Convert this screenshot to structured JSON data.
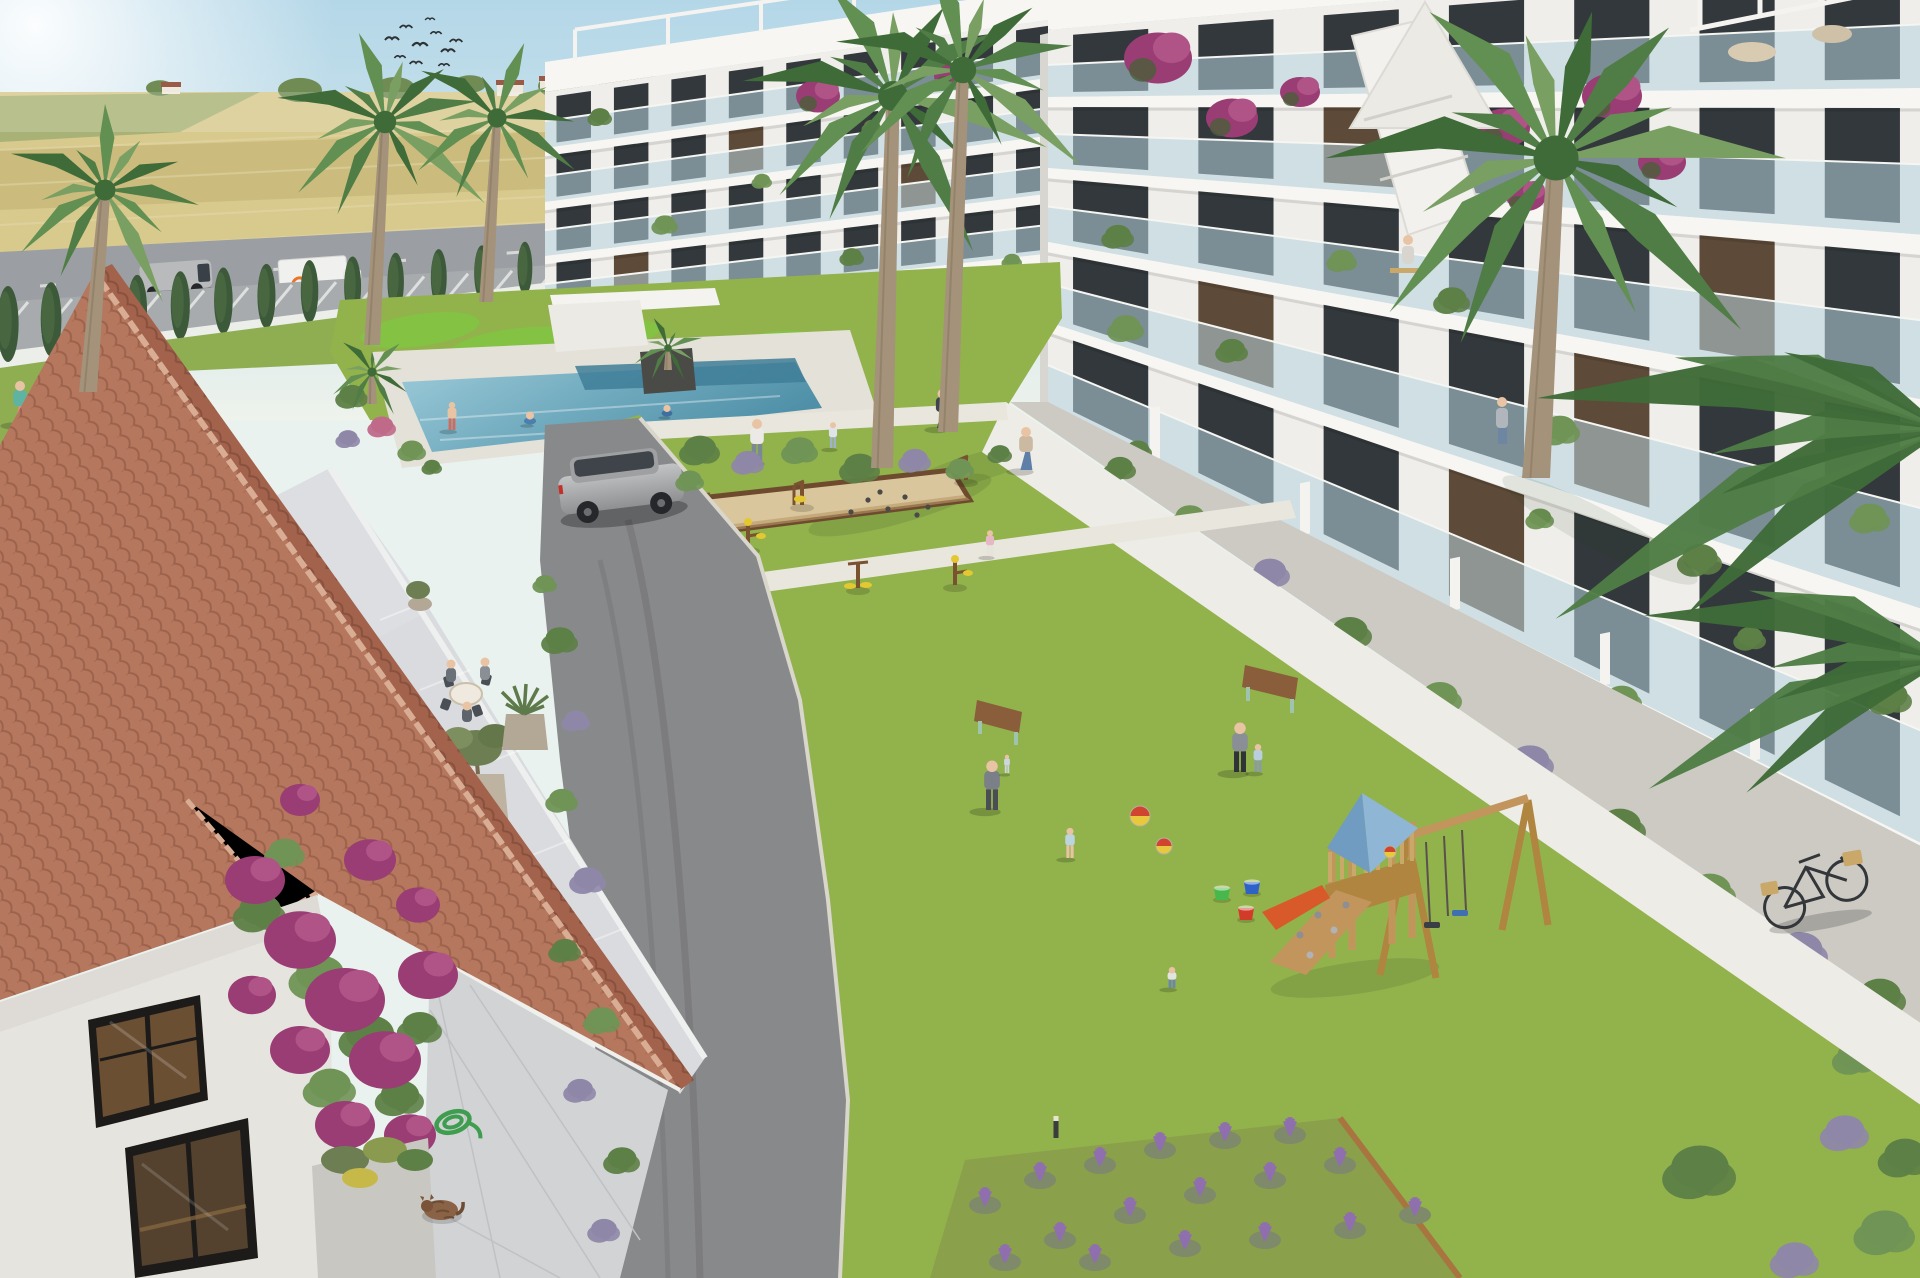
{
  "meta": {
    "title": "Aerial architectural rendering of a new-build residential complex",
    "alt": "Sunny aerial render: white modern apartment blocks with glass balconies around a green courtyard with pool, petanque court, outdoor gym, wooden playground, palm trees, and a terracotta-roofed Spanish house in the foreground; golden fields, a road with vehicles and a cypress-lined fence in the background."
  },
  "palette": {
    "sky1": "#badbe9",
    "sky2": "#eaf2ef",
    "sun": "#ffffff",
    "fieldGold": "#d8c98d",
    "fieldGold2": "#cbbc7e",
    "fieldGreen": "#a9b276",
    "distTree": "#708b54",
    "road": "#9b9fa3",
    "parking": "#a7abae",
    "fence": "#eceee9",
    "cypress": "#3c5a39",
    "grass": "#92b24c",
    "grassStrip": "#8fae52",
    "mound": "#84c244",
    "path": "#e9e7dd",
    "walkway": "#edece6",
    "asphalt": "#88898b",
    "curb": "#d9d6cc",
    "deck": "#e3e1d8",
    "pool1": "#93c6d6",
    "pool2": "#4f90a8",
    "poolDeep": "#3f7e98",
    "white": "#f4f3f0",
    "slab": "#f7f6f3",
    "face": "#efeeea",
    "faceShade": "#e1dfd9",
    "glass": "#b7d3de",
    "win": "#33383c",
    "winWarm": "#5d4a38",
    "roofA": "#b5775d",
    "roofB": "#a2624c",
    "ridge": "#d9ad93",
    "stucco": "#e6e4df",
    "terrace": "#d9dbde",
    "pavers": "#d2d3d5",
    "planter": "#cccac3",
    "g1": "#5d8046",
    "g2": "#6f9455",
    "lav": "#8f87a8",
    "lavPurple": "#8f6fae",
    "pink": "#c06a8a",
    "boug": "#993d74",
    "boug2": "#b05488",
    "wood": "#c2955c",
    "woodDark": "#9c7240",
    "playRoofL": "#6f9cc0",
    "playRoofR": "#8fb6d4",
    "slide": "#d85a2b",
    "sand": "#d9c69c",
    "sandEdge": "#6e4a2e",
    "yellow": "#e3c832",
    "skin": "#e9c4a4",
    "suv": "#a8a9ab",
    "van": "#b9babc",
    "truck": "#f0f0ee",
    "redCar": "#c4342b",
    "bench": "#8a5d3b",
    "benchLeg": "#9fc4ad",
    "bike": "#33363a",
    "basket": "#c9a86a",
    "cat": "#8a6246",
    "hose": "#3f9d4f",
    "trunk": "#a4927a",
    "palm1": "#4f7d45",
    "palm2": "#628f52",
    "palm3": "#79a062",
    "palmDark": "#3f6b38",
    "bird": "#2c3134"
  },
  "buildings": {
    "center": {
      "x1": 545,
      "x2": 1062,
      "bays": 9,
      "slabL": 8,
      "slabR": 10,
      "boundaries": [
        [
          92,
          18
        ],
        [
          148,
          76
        ],
        [
          202,
          134
        ],
        [
          256,
          192
        ],
        [
          310,
          252
        ],
        [
          352,
          300
        ]
      ],
      "warm": [
        [],
        [
          3
        ],
        [
          6
        ],
        [
          1
        ],
        []
      ],
      "parapet": {
        "top": [
          62,
          -14
        ]
      },
      "pergola": {
        "x1": 575,
        "x2": 1040,
        "n": 6,
        "h": 28
      }
    },
    "right": {
      "x1": 1048,
      "x2": 1925,
      "bays": 7,
      "slabL": 10,
      "slabR": 20,
      "boundaries": [
        [
          30,
          -45
        ],
        [
          97,
          88
        ],
        [
          168,
          235
        ],
        [
          242,
          400
        ],
        [
          322,
          610
        ],
        [
          405,
          845
        ]
      ],
      "warm": [
        [],
        [
          2
        ],
        [
          5
        ],
        [
          1,
          4
        ],
        [
          3
        ]
      ],
      "parapet": {
        "top": [
          -6,
          -95
        ]
      },
      "dividers": [
        1150,
        1300,
        1450,
        1600,
        1750
      ]
    }
  },
  "gen": {
    "birds": [
      [
        392,
        40,
        1
      ],
      [
        406,
        28,
        0.9
      ],
      [
        420,
        46,
        1.1
      ],
      [
        436,
        34,
        0.8
      ],
      [
        448,
        52,
        1
      ],
      [
        400,
        58,
        0.8
      ],
      [
        416,
        64,
        0.9
      ],
      [
        430,
        20,
        0.7
      ],
      [
        444,
        66,
        0.8
      ],
      [
        456,
        42,
        0.9
      ]
    ],
    "cypresses": {
      "x1": 8,
      "y1": 362,
      "x2": 1128,
      "y2": 216,
      "n": 27,
      "h1": 76,
      "h2": 26
    },
    "parking_lines": {
      "x1": 28,
      "y1": 302,
      "x2": 556,
      "y2": 268,
      "n": 13,
      "dx": -30,
      "dy": 36
    },
    "road_dashes": {
      "x1": 40,
      "y1": 286,
      "x2": 1090,
      "y2": 212,
      "n": 10,
      "len": 16
    },
    "dist_trees": [
      [
        300,
        90,
        22
      ],
      [
        395,
        88,
        20
      ],
      [
        470,
        84,
        16
      ],
      [
        560,
        86,
        22
      ],
      [
        640,
        82,
        18
      ],
      [
        700,
        86,
        16
      ],
      [
        860,
        84,
        20
      ],
      [
        960,
        82,
        16
      ],
      [
        1040,
        84,
        18
      ],
      [
        160,
        88,
        14
      ]
    ],
    "houses": [
      [
        497,
        84,
        26,
        12
      ],
      [
        540,
        80,
        20,
        10
      ],
      [
        600,
        84,
        26,
        10
      ],
      [
        162,
        86,
        18,
        8
      ]
    ],
    "mounds": [
      [
        420,
        330,
        60,
        16,
        -8
      ],
      [
        520,
        346,
        70,
        18,
        -6
      ],
      [
        610,
        333,
        50,
        14,
        -5
      ],
      [
        470,
        363,
        80,
        16,
        -7
      ],
      [
        700,
        352,
        46,
        12,
        -4
      ],
      [
        780,
        342,
        40,
        11,
        -4
      ]
    ],
    "balcony_plants": [
      [
        600,
        118,
        12,
        "g1"
      ],
      [
        665,
        226,
        13,
        "g2"
      ],
      [
        703,
        298,
        12,
        "g1"
      ],
      [
        762,
        182,
        10,
        "g2"
      ],
      [
        852,
        258,
        12,
        "g1"
      ],
      [
        948,
        298,
        11,
        "g2"
      ],
      [
        872,
        128,
        10,
        "g1"
      ],
      [
        1012,
        262,
        10,
        "g2"
      ],
      [
        1118,
        238,
        16,
        "g1"
      ],
      [
        1126,
        330,
        18,
        "g2"
      ],
      [
        1232,
        352,
        16,
        "g1"
      ],
      [
        1342,
        262,
        15,
        "g2"
      ],
      [
        1452,
        302,
        18,
        "g1"
      ],
      [
        1560,
        432,
        20,
        "g2"
      ],
      [
        1700,
        562,
        22,
        "g1"
      ],
      [
        1262,
        522,
        16,
        "g2"
      ],
      [
        1422,
        622,
        18,
        "g1"
      ],
      [
        1622,
        702,
        20,
        "g2"
      ],
      [
        1138,
        452,
        14,
        "g1"
      ],
      [
        1870,
        520,
        20,
        "g2"
      ],
      [
        1890,
        700,
        22,
        "g1"
      ],
      [
        1540,
        520,
        14,
        "g2"
      ],
      [
        1750,
        640,
        16,
        "g1"
      ]
    ],
    "bougainvillea": [
      [
        1158,
        58,
        34
      ],
      [
        1232,
        118,
        26
      ],
      [
        1300,
        92,
        20
      ],
      [
        1612,
        96,
        30
      ],
      [
        1662,
        162,
        24
      ],
      [
        1504,
        128,
        26
      ],
      [
        1526,
        196,
        20
      ],
      [
        818,
        96,
        22
      ],
      [
        952,
        76,
        18
      ]
    ],
    "wall_bougainvillea": [
      [
        255,
        880,
        30
      ],
      [
        300,
        940,
        36
      ],
      [
        345,
        1000,
        40
      ],
      [
        385,
        1060,
        36
      ],
      [
        300,
        1050,
        30
      ],
      [
        345,
        1125,
        30
      ],
      [
        410,
        1135,
        26
      ],
      [
        252,
        995,
        24
      ],
      [
        418,
        905,
        22
      ],
      [
        370,
        860,
        26
      ],
      [
        428,
        975,
        30
      ],
      [
        300,
        800,
        20
      ]
    ],
    "wall_greens": [
      [
        260,
        915,
        26,
        "g1"
      ],
      [
        320,
        980,
        30,
        "g2"
      ],
      [
        370,
        1040,
        30,
        "g1"
      ],
      [
        330,
        1090,
        26,
        "g2"
      ],
      [
        400,
        1100,
        24,
        "g1"
      ],
      [
        285,
        855,
        20,
        "g2"
      ],
      [
        420,
        1030,
        22,
        "g1"
      ]
    ],
    "shrub_row_pool": [
      [
        700,
        452,
        20,
        "g1"
      ],
      [
        748,
        464,
        16,
        "lav"
      ],
      [
        800,
        452,
        18,
        "g2"
      ],
      [
        860,
        470,
        20,
        "g1"
      ],
      [
        915,
        462,
        16,
        "lav"
      ],
      [
        960,
        470,
        14,
        "g2"
      ],
      [
        690,
        482,
        14,
        "g2"
      ],
      [
        1000,
        455,
        12,
        "g1"
      ]
    ],
    "bushes_left_path": [
      [
        560,
        642,
        18,
        "g1"
      ],
      [
        576,
        722,
        14,
        "lav"
      ],
      [
        562,
        802,
        16,
        "g2"
      ],
      [
        588,
        882,
        18,
        "lav"
      ],
      [
        565,
        952,
        16,
        "g1"
      ],
      [
        602,
        1022,
        18,
        "g2"
      ],
      [
        580,
        1092,
        16,
        "lav"
      ],
      [
        622,
        1162,
        18,
        "g1"
      ],
      [
        604,
        1232,
        16,
        "lav"
      ],
      [
        545,
        585,
        12,
        "g2"
      ]
    ],
    "pool_west_bushes": [
      [
        352,
        398,
        16,
        "g1"
      ],
      [
        382,
        428,
        14,
        "pink"
      ],
      [
        412,
        452,
        14,
        "g2"
      ],
      [
        348,
        440,
        12,
        "lav"
      ],
      [
        432,
        468,
        10,
        "g1"
      ]
    ],
    "planter_band_bushes": [
      [
        1120,
        470,
        16,
        "g1"
      ],
      [
        1190,
        520,
        18,
        "g2"
      ],
      [
        1270,
        575,
        20,
        "lav"
      ],
      [
        1350,
        635,
        22,
        "g1"
      ],
      [
        1440,
        700,
        22,
        "g2"
      ],
      [
        1530,
        765,
        24,
        "lav"
      ],
      [
        1620,
        830,
        26,
        "g1"
      ],
      [
        1710,
        895,
        26,
        "g2"
      ],
      [
        1800,
        955,
        28,
        "lav"
      ],
      [
        1880,
        1000,
        26,
        "g1"
      ],
      [
        1855,
        1060,
        22,
        "g2"
      ]
    ],
    "corner_bushes": [
      [
        1700,
        1175,
        36,
        "g1"
      ],
      [
        1845,
        1135,
        24,
        "lav"
      ],
      [
        1885,
        1235,
        30,
        "g2"
      ],
      [
        1795,
        1262,
        24,
        "lav"
      ],
      [
        1905,
        1160,
        26,
        "g1"
      ]
    ],
    "lavender_clusters": [
      [
        985,
        1205
      ],
      [
        1040,
        1180
      ],
      [
        1100,
        1165
      ],
      [
        1160,
        1150
      ],
      [
        1225,
        1140
      ],
      [
        1290,
        1135
      ],
      [
        1060,
        1240
      ],
      [
        1130,
        1215
      ],
      [
        1200,
        1195
      ],
      [
        1270,
        1180
      ],
      [
        1340,
        1165
      ],
      [
        1005,
        1262
      ],
      [
        1095,
        1262
      ],
      [
        1185,
        1248
      ],
      [
        1265,
        1240
      ],
      [
        1350,
        1230
      ],
      [
        1415,
        1215
      ],
      [
        640,
        1220
      ],
      [
        660,
        1260
      ]
    ],
    "boules": [
      [
        868,
        500
      ],
      [
        888,
        509
      ],
      [
        905,
        497
      ],
      [
        928,
        507
      ],
      [
        851,
        512
      ],
      [
        917,
        515
      ],
      [
        880,
        492
      ]
    ],
    "bollards": [
      [
        756,
        592
      ],
      [
        792,
        762
      ],
      [
        818,
        938
      ],
      [
        834,
        1122
      ],
      [
        722,
        578
      ],
      [
        1056,
        1138
      ]
    ],
    "gym": [
      [
        700,
        520
      ],
      [
        748,
        548
      ],
      [
        802,
        505
      ],
      [
        858,
        588
      ],
      [
        955,
        585
      ],
      [
        966,
        480
      ]
    ],
    "buckets": [
      [
        1222,
        896,
        "#49b84c"
      ],
      [
        1252,
        890,
        "#2f62c8"
      ],
      [
        1246,
        916,
        "#d23a2a"
      ]
    ],
    "balls": [
      [
        1140,
        816,
        10
      ],
      [
        1164,
        846,
        8
      ],
      [
        1390,
        852,
        6
      ]
    ],
    "people": [
      {
        "x": 20,
        "y": 424,
        "h": 40,
        "shirt": "#5fb3a1",
        "pants": "#e58a9a",
        "pose": "walk",
        "label": "woman-walking-roadside"
      },
      {
        "x": 452,
        "y": 430,
        "h": 26,
        "shirt": "#e9c4a4",
        "pants": "#d16a5a",
        "pose": "stand",
        "label": "swimmer-poolside"
      },
      {
        "x": 530,
        "y": 424,
        "h": 20,
        "shirt": "#e9c4a4",
        "pants": "#4a7fae",
        "pose": "swim",
        "label": "swimmer-in-pool"
      },
      {
        "x": 667,
        "y": 416,
        "h": 18,
        "shirt": "#e9c4a4",
        "pants": "#3f6f9f",
        "pose": "swim",
        "label": "swimmer-in-pool"
      },
      {
        "x": 942,
        "y": 428,
        "h": 36,
        "shirt": "#3d4450",
        "pants": "#3d4450",
        "pose": "walk",
        "label": "resident-on-walkway"
      },
      {
        "x": 1026,
        "y": 470,
        "h": 40,
        "shirt": "#cbb9a2",
        "pants": "#5d7fa8",
        "pose": "walk",
        "label": "resident-with-backpack"
      },
      {
        "x": 757,
        "y": 462,
        "h": 40,
        "shirt": "#eceae6",
        "pants": "#7c8894",
        "pose": "stand",
        "label": "adult-playing-ball"
      },
      {
        "x": 833,
        "y": 448,
        "h": 24,
        "shirt": "#dfe4ea",
        "pants": "#9fb3c4",
        "pose": "child",
        "label": "child-playing-ball"
      },
      {
        "x": 990,
        "y": 556,
        "h": 24,
        "shirt": "#e6b7c4",
        "pants": "#e6e3da",
        "pose": "child",
        "label": "child-near-walkway"
      },
      {
        "x": 992,
        "y": 810,
        "h": 46,
        "shirt": "#7a7f88",
        "pants": "#4a4d55",
        "pose": "stand",
        "label": "parent-holding-toddler"
      },
      {
        "x": 1007,
        "y": 773,
        "h": 17,
        "shirt": "#cdd6de",
        "pants": "#cdd6de",
        "pose": "child",
        "label": "toddler-in-arms"
      },
      {
        "x": 1070,
        "y": 858,
        "h": 28,
        "shirt": "#bcd4de",
        "pants": "#e9c4a4",
        "pose": "child",
        "label": "toddler-in-dress"
      },
      {
        "x": 1240,
        "y": 772,
        "h": 46,
        "shirt": "#8a8f96",
        "pants": "#2f3337",
        "pose": "stand",
        "label": "adult-with-child"
      },
      {
        "x": 1258,
        "y": 772,
        "h": 26,
        "shirt": "#b9cfdd",
        "pants": "#8a9aa8",
        "pose": "child",
        "label": "child-holding-hand"
      },
      {
        "x": 1172,
        "y": 988,
        "h": 26,
        "shirt": "#e3e4e2",
        "pants": "#6a86a8",
        "pose": "crouch",
        "label": "child-crouching"
      }
    ],
    "palms": [
      {
        "cx": 105,
        "cy": 190,
        "len": 105,
        "n": 11,
        "tx": 88,
        "ty": 392,
        "tw": 9
      },
      {
        "cx": 385,
        "cy": 122,
        "len": 112,
        "n": 12,
        "tx": 372,
        "ty": 345,
        "tw": 8
      },
      {
        "cx": 497,
        "cy": 118,
        "len": 96,
        "n": 10,
        "tx": 486,
        "ty": 302,
        "tw": 7
      },
      {
        "cx": 372,
        "cy": 372,
        "len": 46,
        "n": 9,
        "tx": 372,
        "ty": 404,
        "tw": 5
      },
      {
        "cx": 668,
        "cy": 348,
        "len": 38,
        "n": 8,
        "tx": 668,
        "ty": 370,
        "tw": 4
      },
      {
        "cx": 893,
        "cy": 96,
        "len": 150,
        "n": 13,
        "tx": 882,
        "ty": 468,
        "tw": 11
      },
      {
        "cx": 963,
        "cy": 70,
        "len": 132,
        "n": 12,
        "tx": 948,
        "ty": 432,
        "tw": 10
      },
      {
        "cx": 1556,
        "cy": 158,
        "len": 225,
        "n": 14,
        "tx": 1536,
        "ty": 478,
        "tw": 14
      }
    ],
    "overhang": [
      {
        "x": 1945,
        "y": 430,
        "len": 400,
        "n": 7,
        "a0": 150,
        "a1": 212
      },
      {
        "x": 1945,
        "y": 660,
        "len": 300,
        "n": 6,
        "a0": 152,
        "a1": 206
      }
    ]
  }
}
